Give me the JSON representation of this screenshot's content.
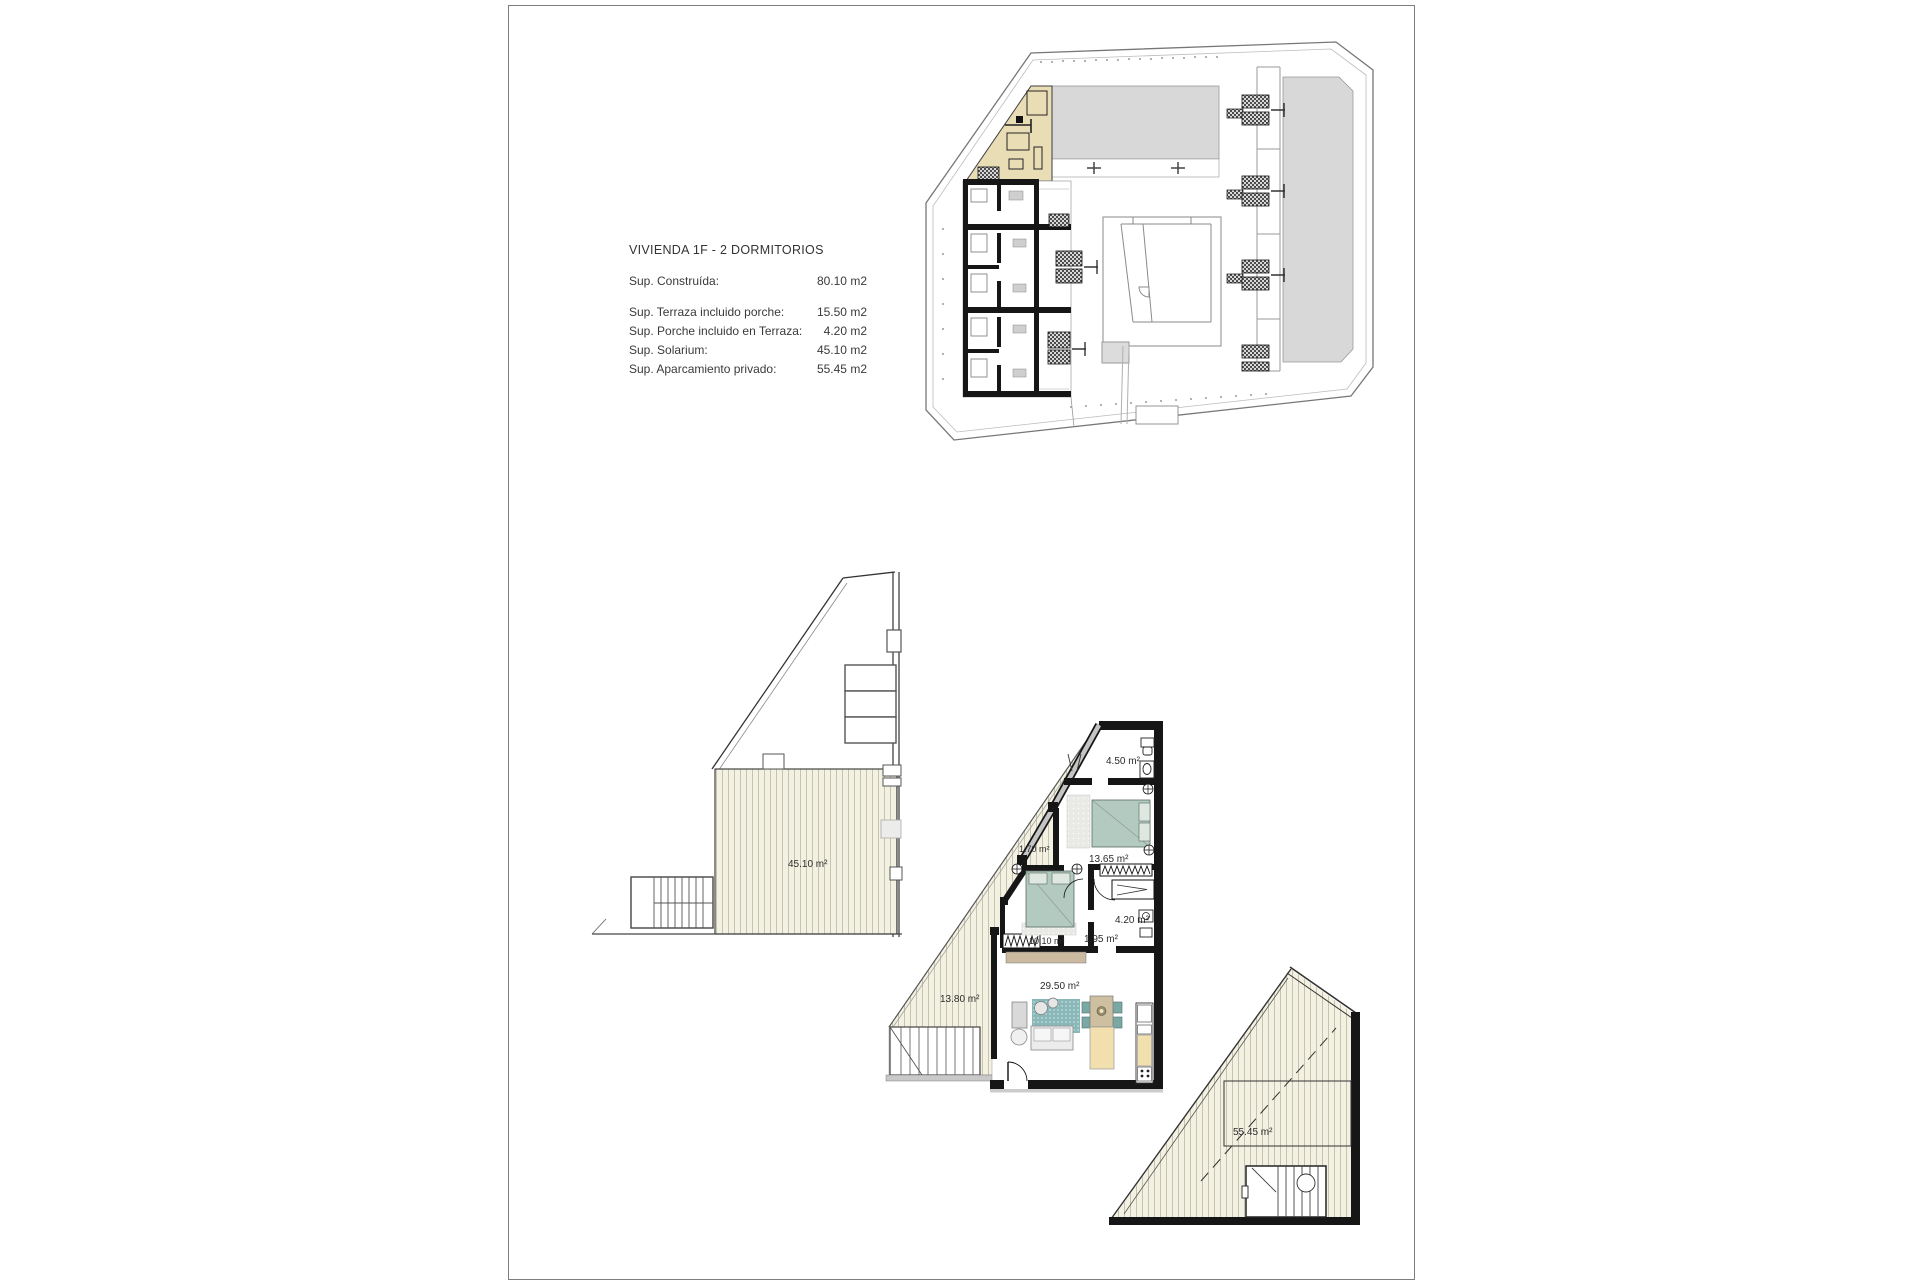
{
  "sheet": {
    "background": "#ffffff",
    "border_color": "#7d7d7d"
  },
  "info": {
    "title": "VIVIENDA  1F - 2 DORMITORIOS",
    "rows": [
      {
        "label": "Sup. Construída:",
        "value": "80.10 m2"
      },
      {
        "label": "Sup. Terraza incluido porche:",
        "value": "15.50 m2"
      },
      {
        "label": "Sup. Porche incluido en Terraza:",
        "value": "4.20 m2"
      },
      {
        "label": "Sup. Solarium:",
        "value": "45.10 m2"
      },
      {
        "label": "Sup. Aparcamiento privado:",
        "value": "55.45 m2"
      }
    ]
  },
  "plans": {
    "site": {
      "name": "Planta de conjunto"
    },
    "solarium": {
      "area_label": "45.10 m²"
    },
    "main": {
      "labels": {
        "bath1": "4.50 m²",
        "porch": "1.70 m²",
        "bedroom1": "13.65 m²",
        "bath2": "4.20 m²",
        "hall": "1.95 m²",
        "bedroom2": "10.10 m²",
        "living": "29.50 m²",
        "terrace": "13.80 m²"
      }
    },
    "parking": {
      "area_label": "55.45 m²"
    }
  },
  "colors": {
    "deck": "#f3f1e1",
    "deck_stripe": "#c6c3b0",
    "highlight_unit": "#e9ddb6",
    "gray_area": "#d8d8d8",
    "bed": "#b2cabf",
    "rug": "#8ab8b8",
    "table": "#cdbf9f",
    "kitchen_tan": "#f2dfae",
    "wall": "#161616"
  }
}
